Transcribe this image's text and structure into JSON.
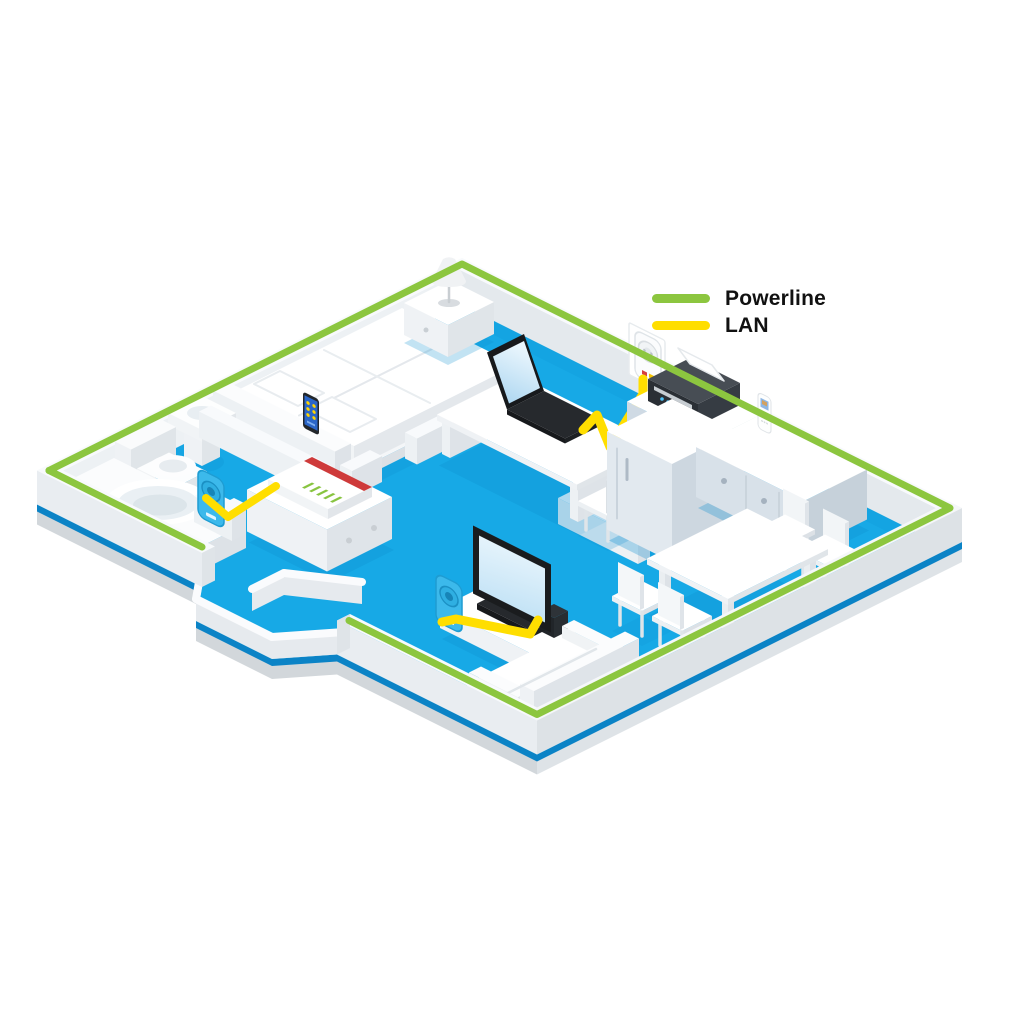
{
  "legend": {
    "items": [
      {
        "id": "powerline",
        "label": "Powerline",
        "color": "#8CC63F"
      },
      {
        "id": "lan",
        "label": "LAN",
        "color": "#FFDE00"
      }
    ]
  },
  "colors": {
    "background": "#FFFFFF",
    "floor_blue": "#17A9E6",
    "floor_shadow": "#0D8FD0",
    "slab_edge_blue": "#0B83C6",
    "slab_side_gray": "#D2D7DB",
    "outer_wall_top": "#F8FAFC",
    "wall_face_light": "#EDF1F4",
    "wall_face_dark": "#DDE2E6",
    "powerline_green": "#8CC63F",
    "lan_yellow": "#FFDE00",
    "fritzbox_red": "#CE3A3A",
    "fritzbox_led_green": "#88C440",
    "adapter_cyan": "#3CB9EB",
    "device_dark": "#1A1C1E",
    "screen_blue": "#BFE2F6",
    "kitchen_front": "#CFDAE4",
    "legend_text": "#111111"
  },
  "scene": {
    "description": "Isometric cutaway apartment showing a home network: Powerline signal over the mains wiring (green stripe along outer walls) and LAN cables (yellow) linking devices.",
    "rooms": [
      "bedroom",
      "bathroom",
      "hallway",
      "home-office",
      "kitchen",
      "dining-area",
      "living-room"
    ],
    "network_devices": [
      "fritzbox-router",
      "powerline-adapter-hallway",
      "powerline-adapter-office-socket",
      "powerline-adapter-living-room",
      "smartphone",
      "laptop",
      "tv",
      "game-console",
      "printer",
      "dect-phone"
    ],
    "furniture": [
      "double-bed",
      "nightstand",
      "table-lamp",
      "bathtub",
      "toilet",
      "washbasin",
      "sideboard",
      "desk",
      "desk-chair",
      "tall-cabinet",
      "kitchen-cabinet",
      "kitchen-counter",
      "dining-table",
      "dining-chairs",
      "tv-lowboard",
      "sofa"
    ],
    "connections": [
      {
        "from": "fritzbox-router",
        "to": "powerline-adapter-hallway",
        "type": "LAN"
      },
      {
        "from": "powerline-adapter-office-socket",
        "to": "laptop",
        "type": "LAN"
      },
      {
        "from": "powerline-adapter-living-room",
        "to": "tv",
        "type": "LAN"
      },
      {
        "from": "powerline-adapter-hallway",
        "to": "powerline-adapter-office-socket",
        "type": "Powerline"
      },
      {
        "from": "powerline-adapter-office-socket",
        "to": "powerline-adapter-living-room",
        "type": "Powerline"
      }
    ]
  }
}
